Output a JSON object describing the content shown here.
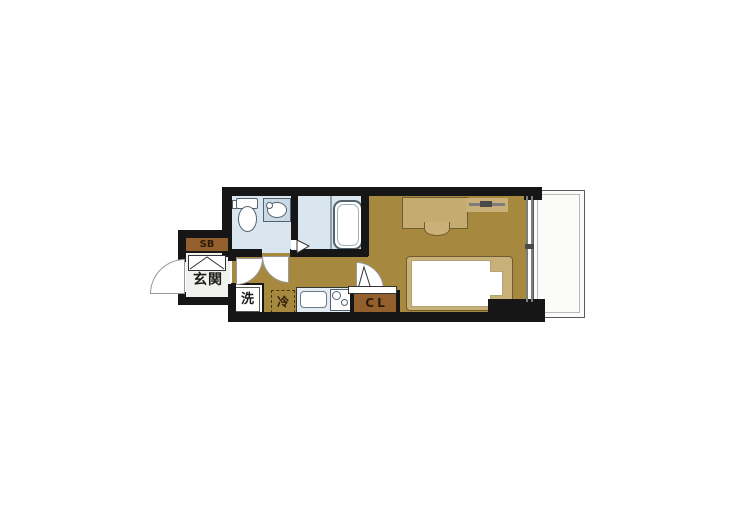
{
  "floorplan": {
    "labels": {
      "entrance": "玄関",
      "shoe_box": "SB",
      "closet": "CL",
      "washer": "洗",
      "refrigerator": "冷"
    },
    "colors": {
      "wall": "#161616",
      "room_floor": "#a6883f",
      "wet_floor": "#dae6ef",
      "entry_floor": "#f1f1ee",
      "furniture_tan": "#c5ab6f",
      "furniture_border": "#6f5d30",
      "label_box_brown": "#93602d",
      "label_dark": "#2e1a07",
      "counter_blue": "#e3ecf2",
      "fixture_outline": "#51616e",
      "window_gray": "#7d7d7d",
      "balcony_border": "#5a5a5a"
    }
  }
}
